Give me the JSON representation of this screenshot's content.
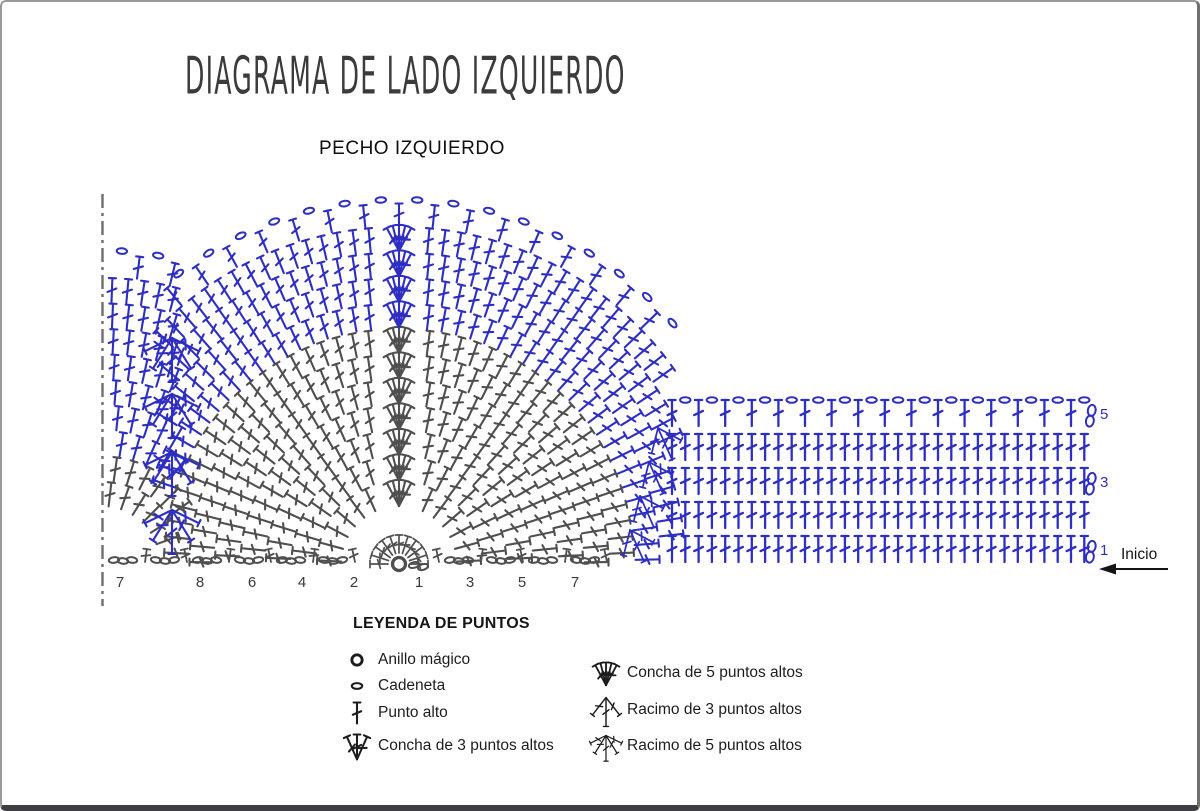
{
  "title": "DIAGRAMA DE LADO IZQUIERDO",
  "subtitle": "PECHO IZQUIERDO",
  "inicio_label": "Inicio",
  "colors": {
    "blue": "#2e2ec2",
    "gray": "#4f4f4f",
    "ink": "#141414",
    "number": "#3a3a3a",
    "band_label": "#3232b4",
    "fold_line": "#6e6e6e",
    "legend_icon": "#1c1c1c"
  },
  "legend": {
    "title": "LEYENDA DE PUNTOS",
    "items": [
      {
        "label": "Anillo mágico",
        "icon": "ring"
      },
      {
        "label": "Cadeneta",
        "icon": "chain"
      },
      {
        "label": "Punto alto",
        "icon": "dc"
      },
      {
        "label": "Concha de 3 puntos altos",
        "icon": "shell3"
      },
      {
        "label": "Concha de 5 puntos altos",
        "icon": "shell5"
      },
      {
        "label": "Racimo de 3 puntos altos",
        "icon": "cluster3"
      },
      {
        "label": "Racimo de 5 puntos altos",
        "icon": "cluster5"
      }
    ]
  },
  "diagram": {
    "fan": {
      "cx": 397,
      "cy": 562,
      "base_radius": 7,
      "row_height": 25.5,
      "rows": 13,
      "gray_rows": 8,
      "stitch_len": 24,
      "dart_x": 170,
      "band_edge_x": 658,
      "spokes": 11
    },
    "left_fan": {
      "cx": 100,
      "cy": 562,
      "rows": 11,
      "gray_rows": 3,
      "dart_offset": 68,
      "outer_chain_row": 11
    },
    "dart_clusters_y": [
      336,
      392,
      450,
      508
    ],
    "band": {
      "x0": 670,
      "stitch_gap": 13.3,
      "count": 32,
      "rows_y": [
        560,
        526,
        492,
        458,
        424
      ],
      "mesh_top_row": true,
      "turning_chain_rows": [
        0,
        2,
        4
      ],
      "turning_chain_x": 1087,
      "label_x": 1098,
      "row_labels": [
        {
          "n": "1",
          "y": 553
        },
        {
          "n": "3",
          "y": 485
        },
        {
          "n": "5",
          "y": 417
        }
      ],
      "edge_clusters": [
        {
          "x": 628,
          "y": 528
        },
        {
          "x": 638,
          "y": 494
        },
        {
          "x": 647,
          "y": 460
        },
        {
          "x": 656,
          "y": 426
        }
      ]
    },
    "foundation": {
      "x_start": 112,
      "x_end": 614,
      "y": 558,
      "group_gap": 42
    },
    "row_numbers_y": 585,
    "row_numbers": [
      {
        "n": "7",
        "x": 118
      },
      {
        "n": "8",
        "x": 198
      },
      {
        "n": "6",
        "x": 250
      },
      {
        "n": "4",
        "x": 300
      },
      {
        "n": "2",
        "x": 352
      },
      {
        "n": "1",
        "x": 417
      },
      {
        "n": "3",
        "x": 468
      },
      {
        "n": "5",
        "x": 520
      },
      {
        "n": "7",
        "x": 573
      }
    ],
    "fold_line": {
      "x": 100.5,
      "y1": 192,
      "y2": 604
    },
    "inicio": {
      "text_x": 1119,
      "text_y": 557,
      "arrow_y": 567,
      "arrow_x1": 1166,
      "arrow_x2": 1112,
      "head_x": 1097
    }
  }
}
